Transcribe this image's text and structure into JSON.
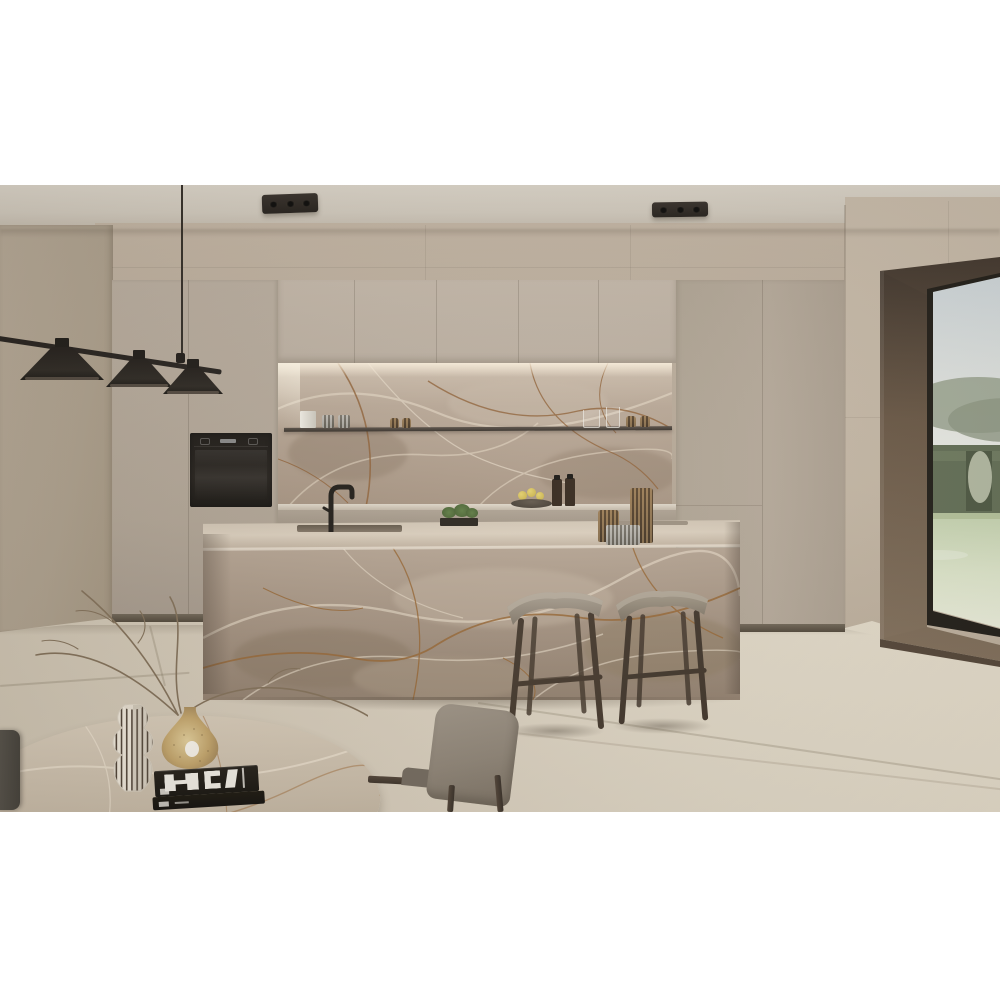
{
  "page": {
    "kind": "product-photo",
    "alt": "Modern kitchen interior with brown-veined taupe marble island and backsplash, greige cabinetry, two wooden bar stools, black pendant lights, corner window with garden view, and a marble dining table with vases and black books",
    "background": "#ffffff"
  },
  "scene": {
    "ceiling_lights_count": 2,
    "pendant_shades_count": 3,
    "bar_stools_count": 2,
    "books_count": 2,
    "labels": {
      "island": "marble kitchen island with sink and faucet",
      "backsplash": "marble backsplash niche with metal shelf",
      "oven": "built-in black wall oven",
      "window": "floor-to-ceiling corner window with wood frame",
      "view": "lawn, hedges and hills under pale sky",
      "table": "organic-shaped marble dining table",
      "vase_striped": "white vase with dark vertical stripes",
      "vase_gold": "speckled gold teardrop vase with dry branches",
      "chair": "grey upholstered dining chair with dark wood frame"
    }
  },
  "palette": {
    "letterbox": "#ffffff",
    "ceiling": "#d2cbbf",
    "back_wall": "#b4a695",
    "right_wall": "#c2b5a3",
    "cabinet_greige": "#b7ab9d",
    "marble_base": "#a3917f",
    "marble_vein_cream": "#e8dcc9",
    "marble_vein_rust": "#8a5a2f",
    "floor": "#d9d0bf",
    "stool_wood": "#40342a",
    "stool_seat": "#948a7c",
    "window_wood": "#5f4f41",
    "hedge_green": "#4e5a42",
    "lawn_green": "#dde6cf",
    "black_accent": "#17130f"
  }
}
